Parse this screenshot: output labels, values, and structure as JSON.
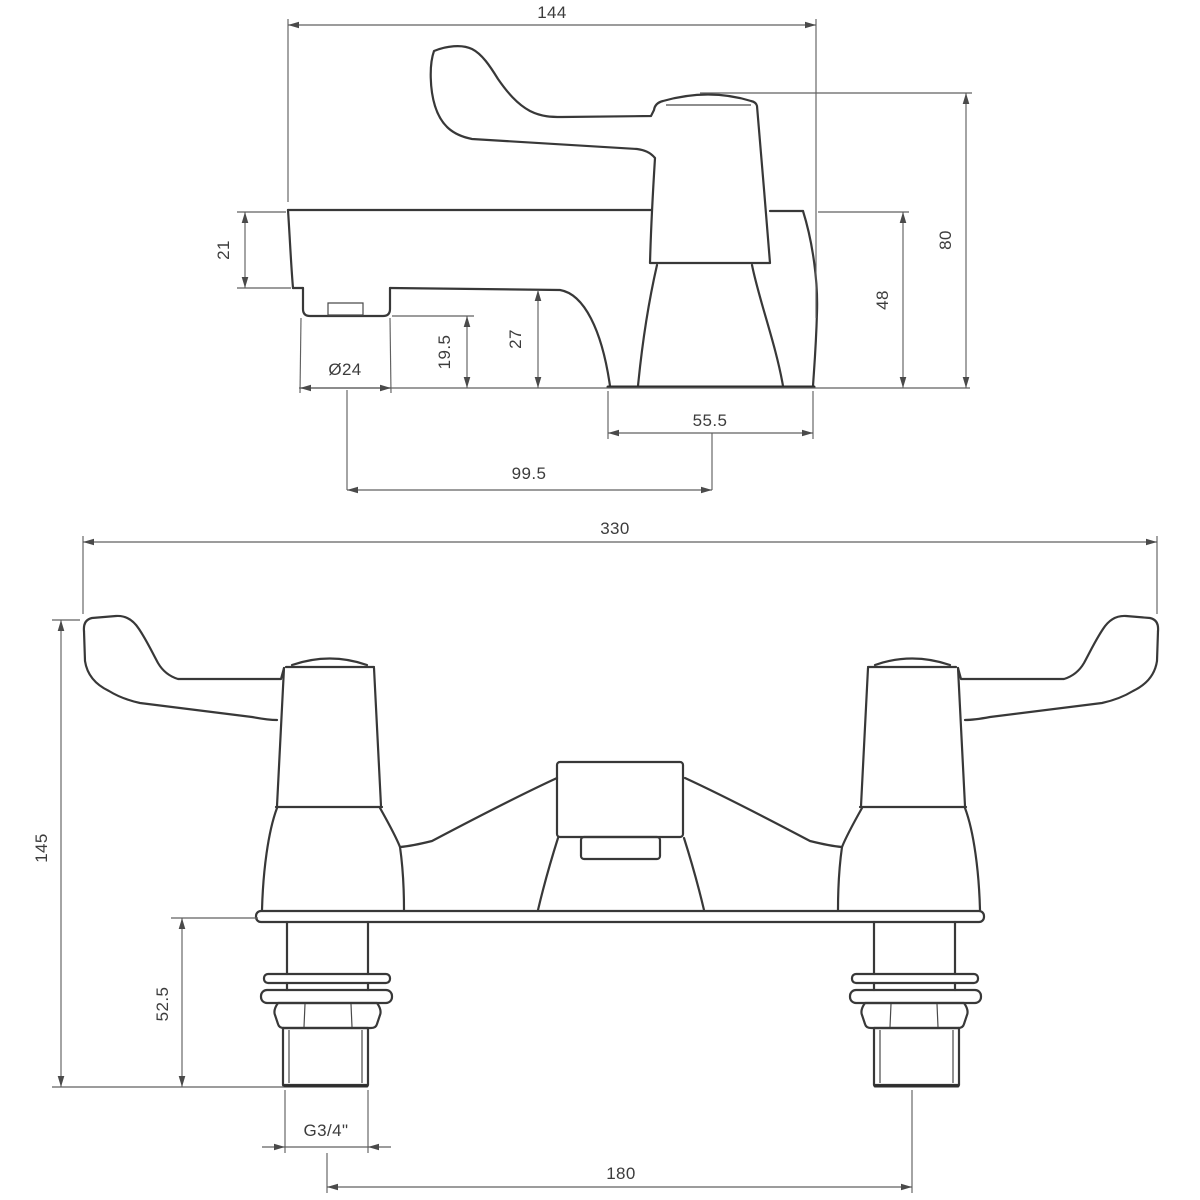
{
  "drawing": {
    "title": "tap technical dimension drawing",
    "side_view": {
      "overall_length": "144",
      "overall_height": "80",
      "handle_to_base": "48",
      "spout_body_height": "21",
      "spout_tip_to_base": "19.5",
      "underside_to_base": "27",
      "spout_diameter": "Ø24",
      "spout_reach": "99.5",
      "base_depth": "55.5"
    },
    "front_view": {
      "overall_width": "330",
      "overall_height": "145",
      "below_deck_length": "52.5",
      "thread_size": "G3/4\"",
      "hole_centres": "180"
    }
  },
  "colors": {
    "background": "#ffffff",
    "outline": "#383838",
    "dimension_lines": "#606060",
    "text": "#3c3c3c"
  }
}
